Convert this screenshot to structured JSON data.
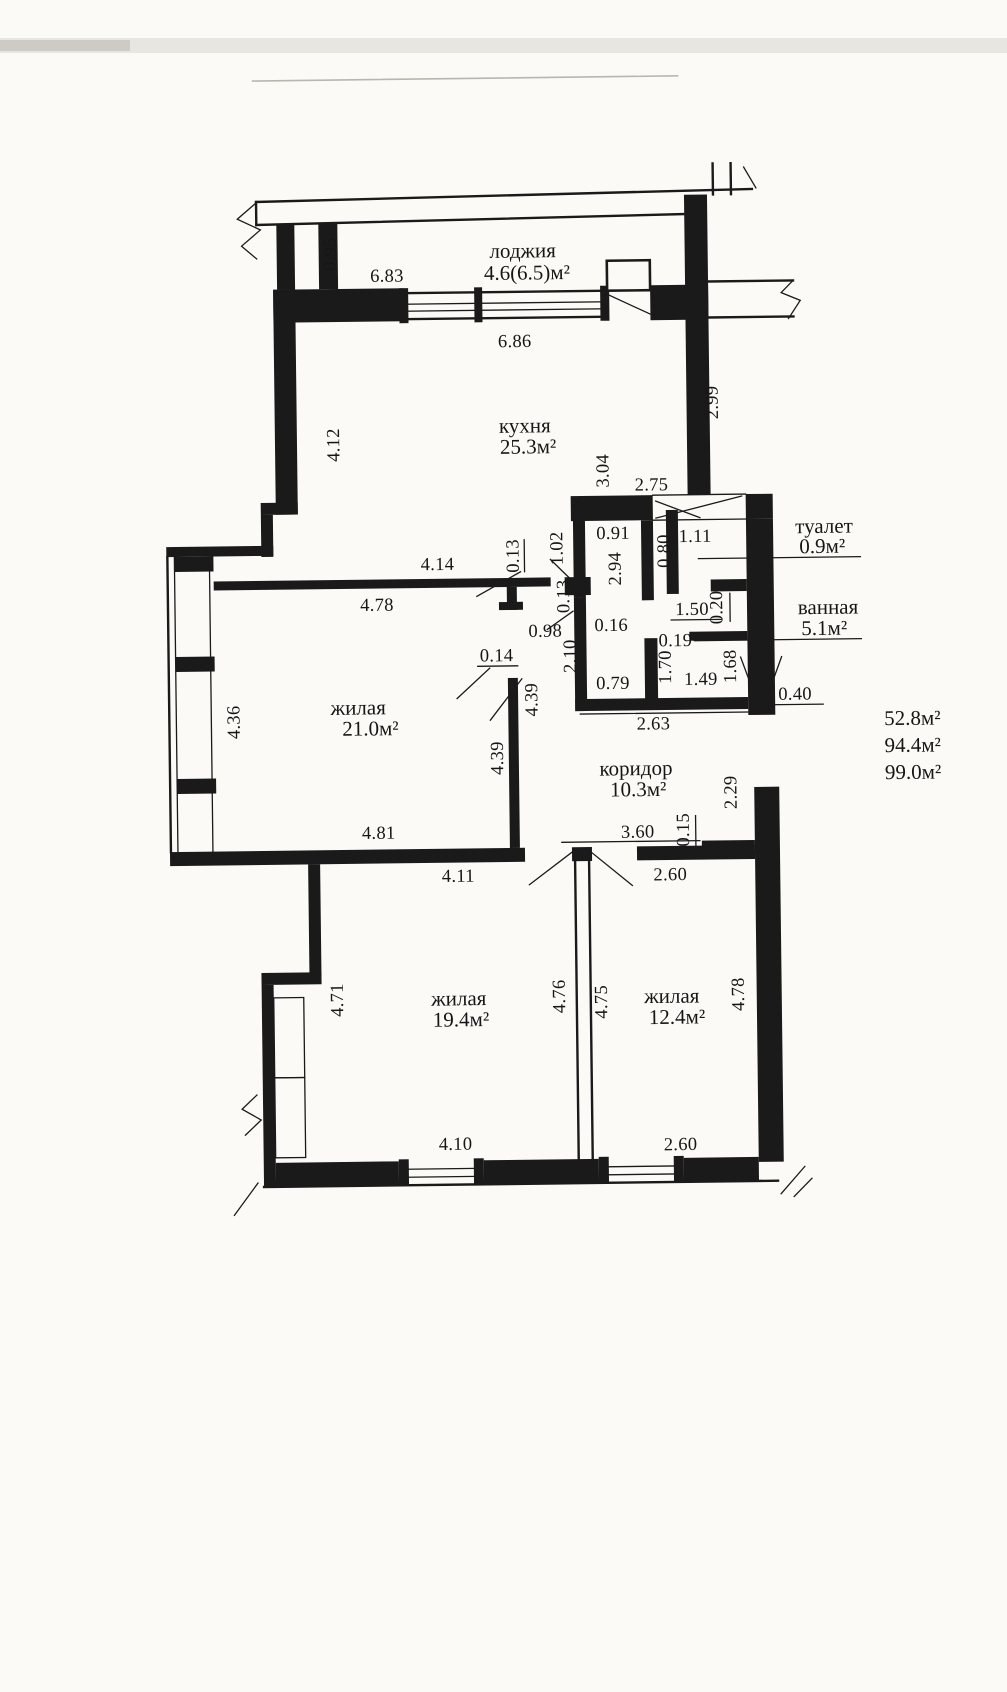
{
  "plan": {
    "rooms": {
      "loggia": {
        "name": "лоджия",
        "area": "4.6(6.5)м²"
      },
      "kitchen": {
        "name": "кухня",
        "area": "25.3м²"
      },
      "toilet": {
        "name": "туалет",
        "area": "0.9м²"
      },
      "bathroom": {
        "name": "ванная",
        "area": "5.1м²"
      },
      "living1": {
        "name": "жилая",
        "area": "21.0м²"
      },
      "corridor": {
        "name": "коридор",
        "area": "10.3м²"
      },
      "living2": {
        "name": "жилая",
        "area": "19.4м²"
      },
      "living3": {
        "name": "жилая",
        "area": "12.4м²"
      }
    },
    "totals": {
      "line1": "52.8м²",
      "line2": "94.4м²",
      "line3": "99.0м²"
    },
    "dimensions": {
      "d095": "0.95",
      "d683": "6.83",
      "d686": "6.86",
      "d412": "4.12",
      "d299": "2.99",
      "d304": "3.04",
      "d275": "2.75",
      "d414": "4.14",
      "d013a": "0.13",
      "d478a": "4.78",
      "d102": "1.02",
      "d091": "0.91",
      "d294": "2.94",
      "d080": "0.80",
      "d111": "1.11",
      "d013b": "0.13",
      "d150": "1.50",
      "d020": "0.20",
      "d098": "0.98",
      "d016": "0.16",
      "d014": "0.14",
      "d210": "2.10",
      "d019": "0.19",
      "d170": "1.70",
      "d149": "1.49",
      "d168": "1.68",
      "d079": "0.79",
      "d263": "2.63",
      "d040": "0.40",
      "d436": "4.36",
      "d439a": "4.39",
      "d439b": "4.39",
      "d481": "4.81",
      "d411": "4.11",
      "d229": "2.29",
      "d360": "3.60",
      "d015": "0.15",
      "d260a": "2.60",
      "d471": "4.71",
      "d476": "4.76",
      "d475": "4.75",
      "d478b": "4.78",
      "d410": "4.10",
      "d260b": "2.60"
    },
    "colors": {
      "ink": "#1a1a1a",
      "paper": "#fbfaf7"
    }
  }
}
